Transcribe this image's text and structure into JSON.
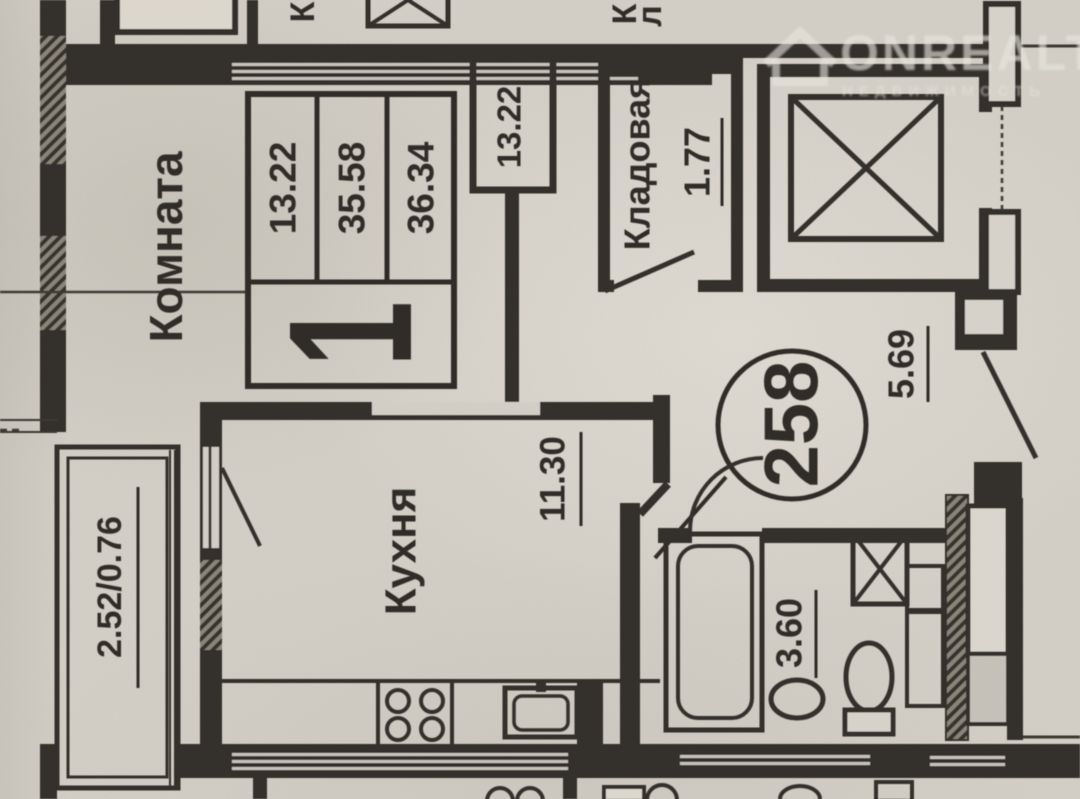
{
  "plan": {
    "apartment_number": "258",
    "stamp": {
      "rooms_count": "1",
      "living_area": "13.22",
      "area": "35.58",
      "total_area": "36.34"
    },
    "rooms": {
      "komnata": {
        "label": "Комната"
      },
      "duct": {
        "area": "13.22"
      },
      "kladovaya": {
        "label": "Кладовая",
        "area": "1.77"
      },
      "hall": {
        "area": "5.69"
      },
      "kitchen": {
        "label": "Кухня",
        "area": "11.30"
      },
      "balcony": {
        "area": "2.52/0.76"
      },
      "bathroom": {
        "area": "3.60"
      }
    },
    "partial_labels": {
      "top_left_letter": "К",
      "top_pantry_letter_1": "К",
      "top_pantry_letter_2": "л"
    }
  },
  "watermark": {
    "brand": "ONREALT",
    "tagline": "НЕДВИЖИМОСТЬ"
  },
  "colors": {
    "paper": "#d4d0c7",
    "ink": "#302e29",
    "watermark": "#ebe8e1"
  }
}
